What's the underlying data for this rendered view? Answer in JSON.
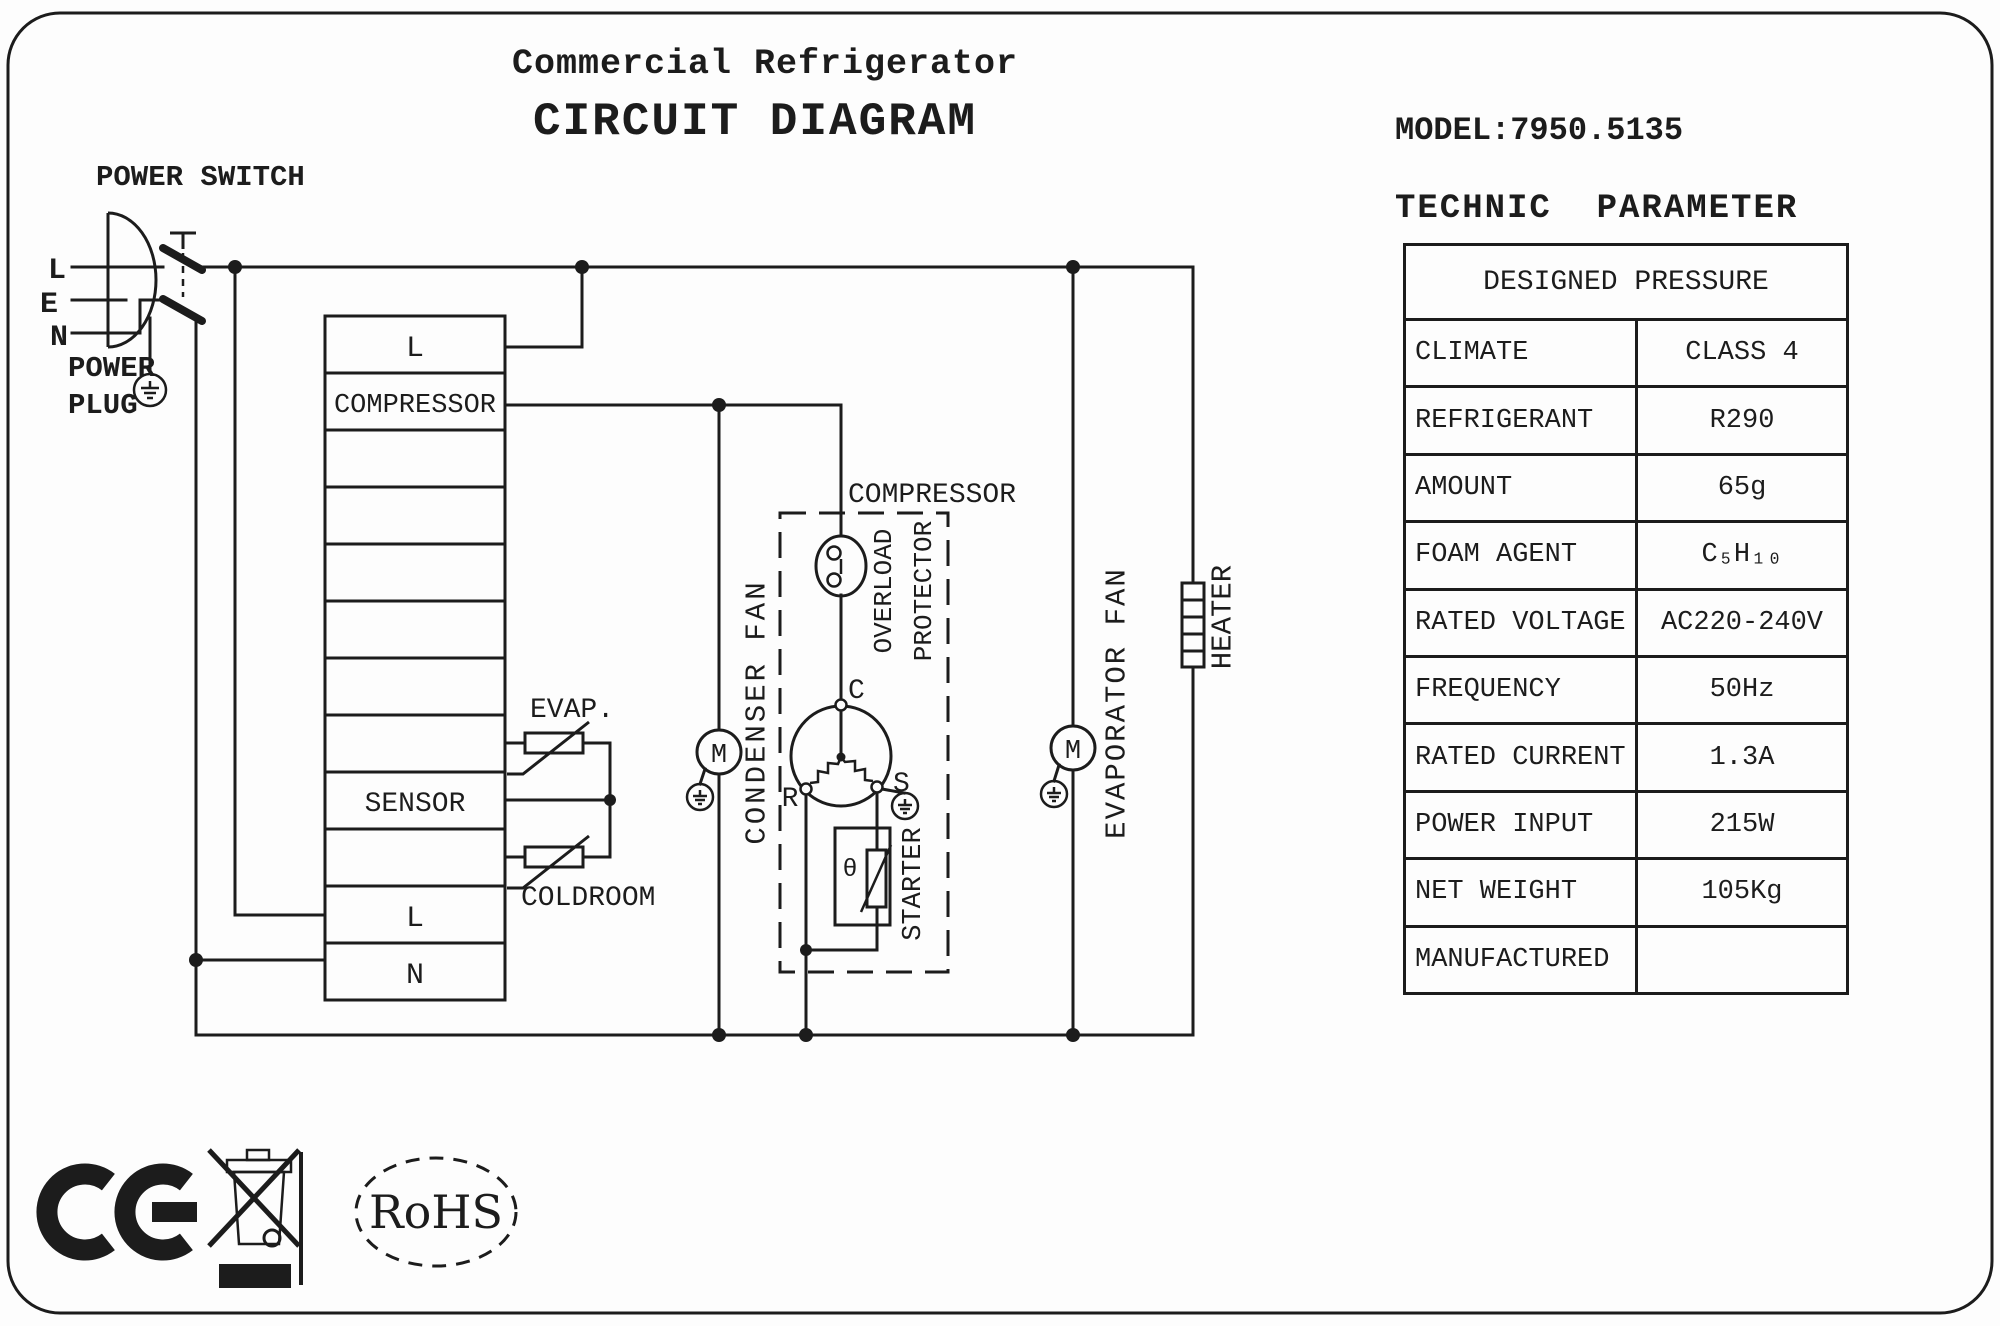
{
  "title": {
    "line1": "Commercial Refrigerator",
    "line2": "CIRCUIT DIAGRAM"
  },
  "right_panel": {
    "model": "MODEL:7950.5135",
    "section_title": "TECHNIC  PARAMETER",
    "table": {
      "header": "DESIGNED PRESSURE",
      "rows": [
        {
          "label": "CLIMATE",
          "value": "CLASS 4"
        },
        {
          "label": "REFRIGERANT",
          "value": "R290"
        },
        {
          "label": "AMOUNT",
          "value": "65g"
        },
        {
          "label": "FOAM AGENT",
          "value": "C₅H₁₀"
        },
        {
          "label": "RATED VOLTAGE",
          "value": "AC220-240V"
        },
        {
          "label": "FREQUENCY",
          "value": "50Hz"
        },
        {
          "label": "RATED CURRENT",
          "value": "1.3A"
        },
        {
          "label": "POWER INPUT",
          "value": "215W"
        },
        {
          "label": "NET WEIGHT",
          "value": "105Kg"
        },
        {
          "label": "MANUFACTURED",
          "value": ""
        }
      ]
    }
  },
  "circuit": {
    "power_switch_label": "POWER SWITCH",
    "power_plug_label_line1": "POWER",
    "power_plug_label_line2": "PLUG",
    "pins": {
      "l": "L",
      "e": "E",
      "n": "N"
    },
    "terminal_block": {
      "row1": "L",
      "row2": "COMPRESSOR",
      "row9": "SENSOR",
      "row11": "L",
      "row12": "N"
    },
    "sensors": {
      "evap": "EVAP.",
      "coldroom": "COLDROOM"
    },
    "condenser_fan_label": "CONDENSER FAN",
    "evaporator_fan_label": "EVAPORATOR FAN",
    "compressor_label": "COMPRESSOR",
    "overload_label_line1": "OVERLOAD",
    "overload_label_line2": "PROTECTOR",
    "starter_label": "STARTER",
    "heater_label": "HEATER",
    "motor_symbol": "M",
    "thermal_symbol": "θ",
    "motor_terminals": {
      "c": "C",
      "r": "R",
      "s": "S"
    }
  },
  "certifications": {
    "rohs": "RoHS"
  }
}
